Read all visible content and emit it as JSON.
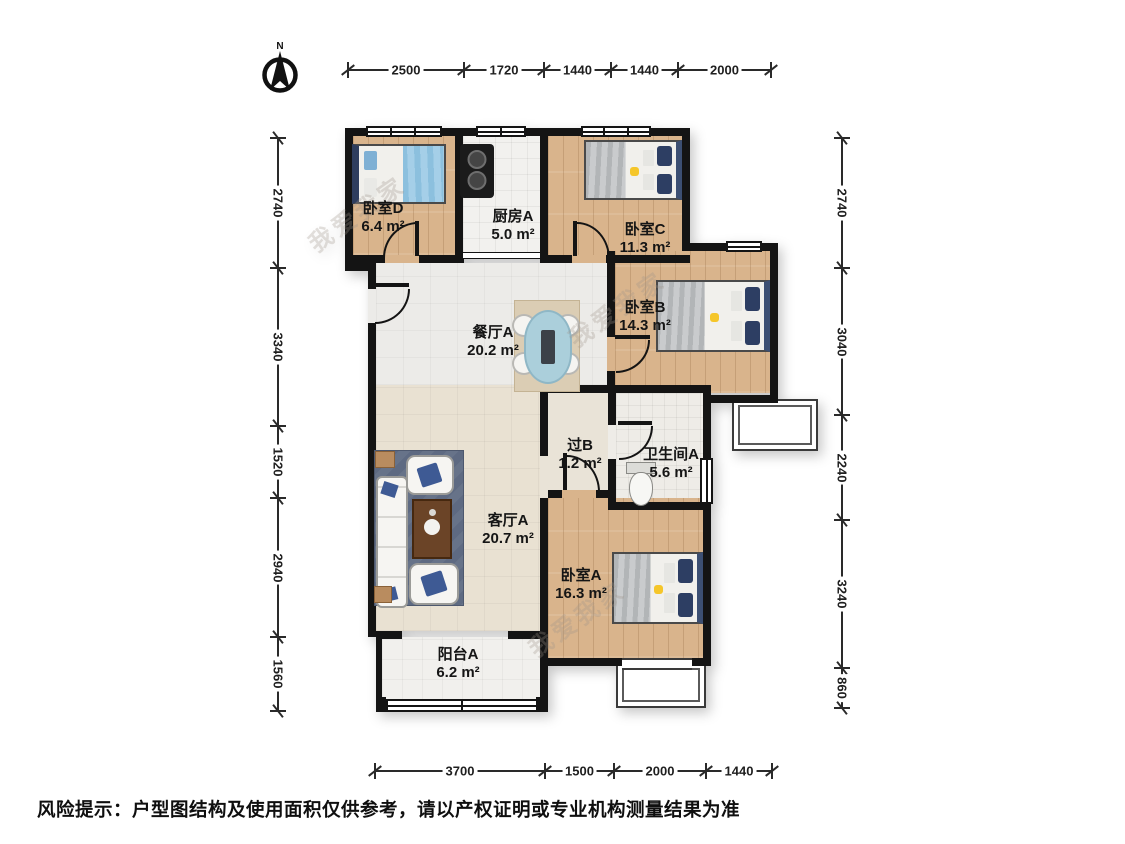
{
  "compass": {
    "label": "N"
  },
  "rooms": [
    {
      "id": "bedroom-d",
      "name": "卧室D",
      "area": "6.4 m²"
    },
    {
      "id": "kitchen-a",
      "name": "厨房A",
      "area": "5.0 m²"
    },
    {
      "id": "bedroom-c",
      "name": "卧室C",
      "area": "11.3 m²"
    },
    {
      "id": "bedroom-b",
      "name": "卧室B",
      "area": "14.3 m²"
    },
    {
      "id": "dining-a",
      "name": "餐厅A",
      "area": "20.2 m²"
    },
    {
      "id": "hall-b",
      "name": "过B",
      "area": "1.2 m²"
    },
    {
      "id": "bathroom-a",
      "name": "卫生间A",
      "area": "5.6 m²"
    },
    {
      "id": "living-a",
      "name": "客厅A",
      "area": "20.7 m²"
    },
    {
      "id": "bedroom-a",
      "name": "卧室A",
      "area": "16.3 m²"
    },
    {
      "id": "balcony-a",
      "name": "阳台A",
      "area": "6.2 m²"
    }
  ],
  "dimensions": {
    "top": [
      "2500",
      "1720",
      "1440",
      "1440",
      "2000"
    ],
    "left": [
      "2740",
      "3340",
      "1520",
      "2940",
      "1560"
    ],
    "right": [
      "2740",
      "3040",
      "2240",
      "3240",
      "860"
    ],
    "bottom": [
      "3700",
      "1500",
      "2000",
      "1440"
    ]
  },
  "watermark": "我爱我家",
  "disclaimer": "风险提示：户型图结构及使用面积仅供参考，请以产权证明或专业机构测量结果为准",
  "colors": {
    "wall": "#141414",
    "wood_floor": "#d9b48c",
    "dim_text": "#1f1f1f",
    "pillow_navy": "#2d3e63",
    "accent_yellow": "#f5c62a",
    "rug_blue": "#5e6a82"
  }
}
